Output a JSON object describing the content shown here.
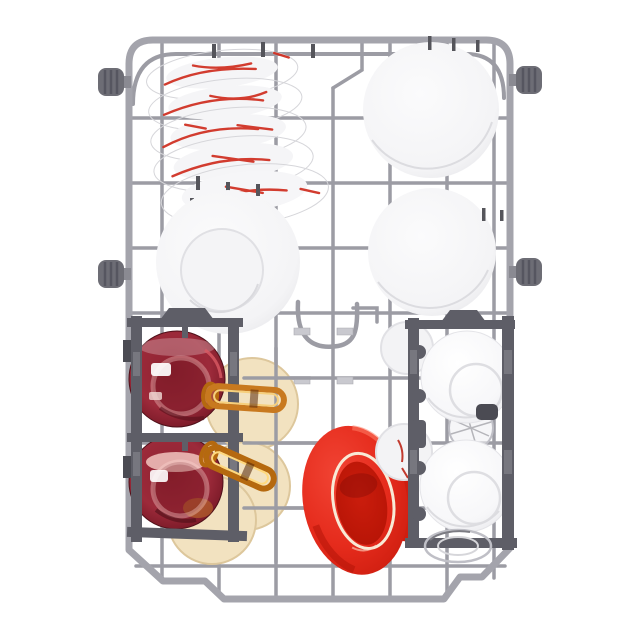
{
  "meta": {
    "title": "Dishwasher lower basket loaded with dishes — top view product photo"
  },
  "colors": {
    "background": "#ffffff",
    "frame": "#a4a4ac",
    "wire": "#9c9ca4",
    "wire_light": "#c9c9cf",
    "metal_dark": "#55555b",
    "roller_body": "#6d6d75",
    "roller_rib": "#565660",
    "holder": "#5e5e67",
    "holder_dark": "#4b4b53",
    "plate_white": "#fbfbfc",
    "plate_edge": "#e7e7ea",
    "plate_line": "#d6d6da",
    "red_plate": "#e52b1c",
    "red_plate_dark": "#a91105",
    "red_plate_ring": "#f8ead6",
    "red_pattern": "#d03224",
    "red_glass_dark": "#54121d",
    "amber": "#c8791f",
    "amber_light": "#f6cf7c",
    "amber_deep": "#b5690f",
    "cream": "#f2e2c0",
    "cream_edge": "#ddc79c",
    "glass_gray": "#bfbfc6",
    "glass_dark": "#46464c"
  },
  "scene": {
    "objects": [
      {
        "label": "Gray wire dishwasher basket frame with four side rollers"
      },
      {
        "label": "Stack of five tilted white plates with red streak pattern",
        "count": "5"
      },
      {
        "label": "Large white dinner plate, top right"
      },
      {
        "label": "White deep plate, middle left"
      },
      {
        "label": "White serving bowl, middle right"
      },
      {
        "label": "Dark gray cup rack holding two dark-red glass cups and two amber glass mugs"
      },
      {
        "label": "Three cream saucers behind the left cup rack"
      },
      {
        "label": "Bright red dinner plate with white ring, leaning"
      },
      {
        "label": "Dark gray cup rack holding two white cups and clear glasses"
      },
      {
        "label": "Clear drinking glasses"
      }
    ]
  }
}
